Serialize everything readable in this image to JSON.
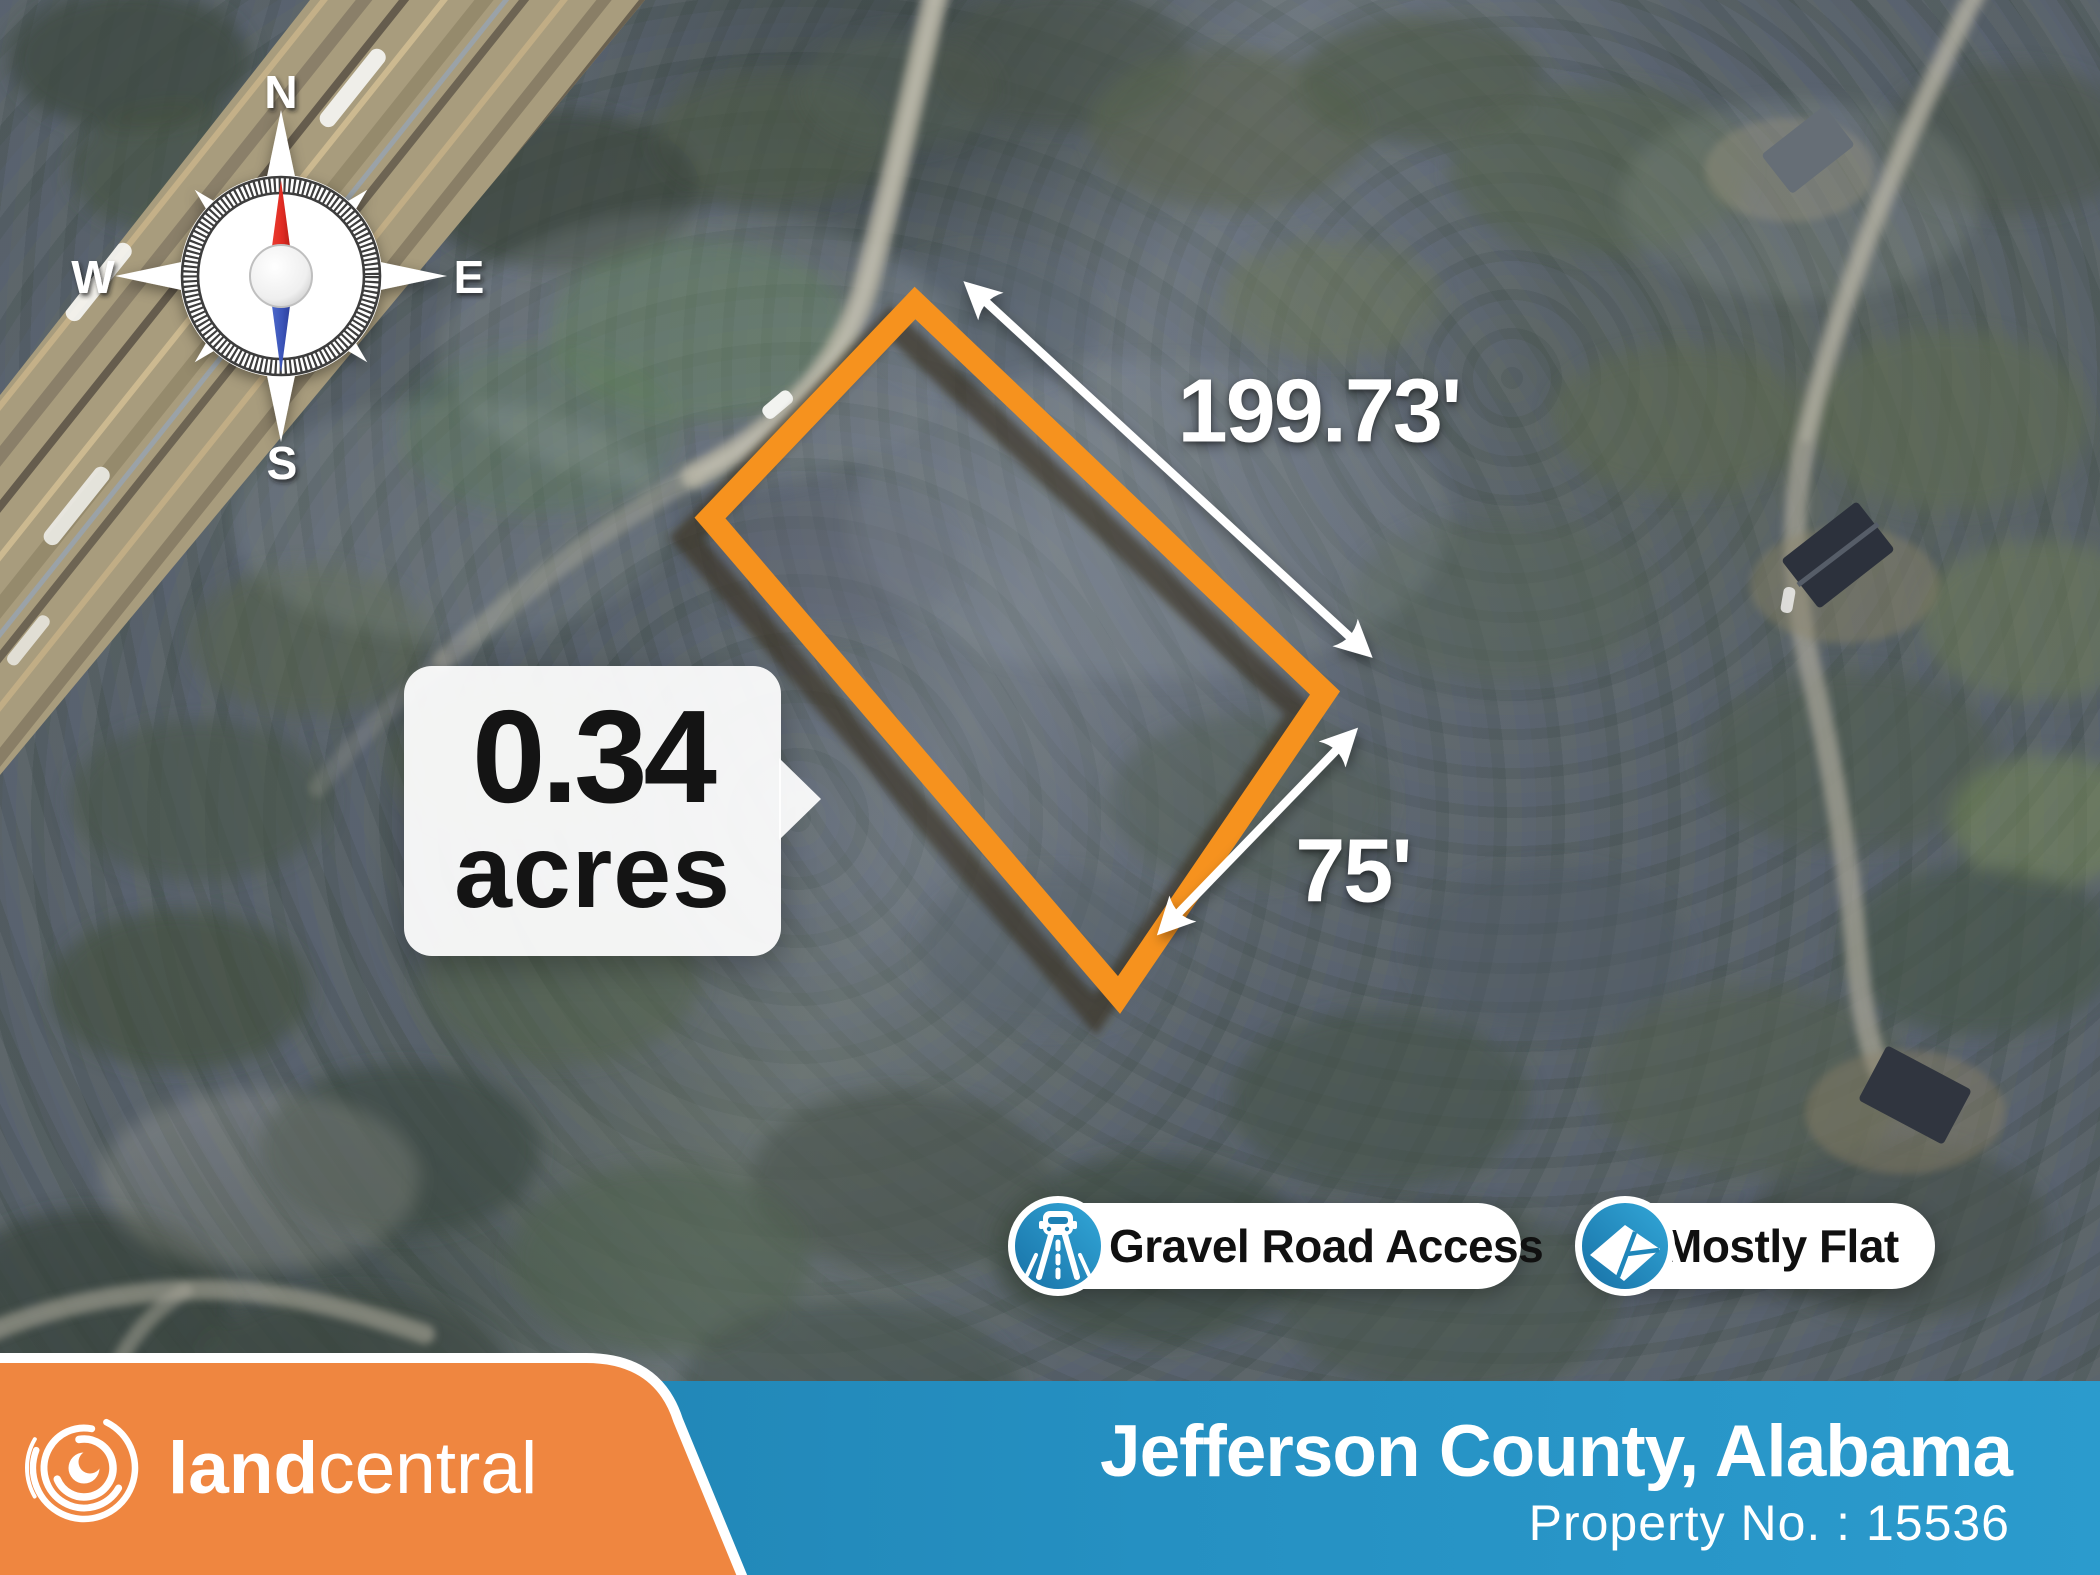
{
  "map": {
    "compass": {
      "north": "N",
      "east": "E",
      "south": "S",
      "west": "W"
    },
    "property": {
      "acreage": "0.34",
      "acreage_unit": "acres",
      "length_label": "199.73'",
      "width_label": "75'",
      "outline_color": "#F6921E"
    },
    "feature_badges": [
      {
        "label": "Gravel Road Access",
        "icon": "gravel-road-icon",
        "icon_color": "#2196CB"
      },
      {
        "label": "Mostly Flat",
        "icon": "flat-terrain-icon",
        "icon_color": "#2196CB"
      }
    ]
  },
  "footer": {
    "brand_bold": "land",
    "brand_light": "central",
    "brand_plate_color": "#EF8640",
    "location": "Jefferson County, Alabama",
    "property_number": "Property No. : 15536",
    "bar_color": "#2187BD"
  }
}
